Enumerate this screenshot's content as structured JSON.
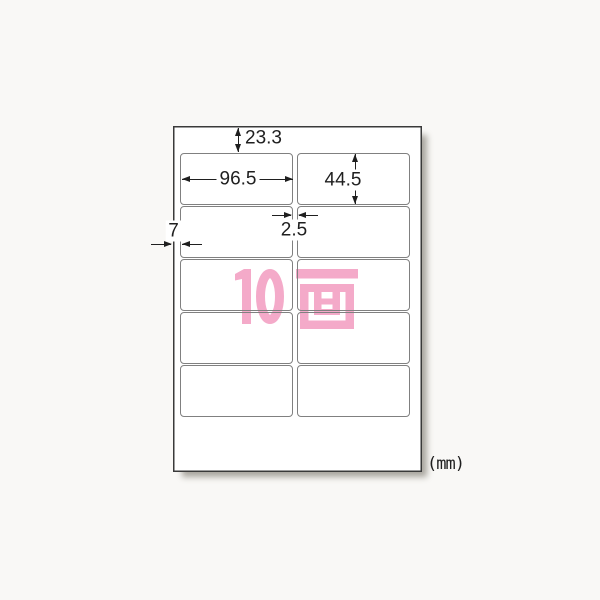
{
  "diagram": {
    "unit_note": "(mm)",
    "face_count": {
      "text": "10面",
      "digits": "10",
      "kanji": "面"
    },
    "dimensions": {
      "top_margin": "23.3",
      "label_width": "96.5",
      "label_height": "44.5",
      "column_gap": "2.5",
      "left_margin": "7"
    },
    "grid": {
      "columns": 2,
      "rows": 5,
      "total_labels": 10
    },
    "colors": {
      "page_bg": "#f9f8f6",
      "sheet_fill": "#ffffff",
      "sheet_border": "#3a3a3a",
      "label_border": "#808080",
      "dim_ink": "#1f1f1f",
      "face_count_pink": "#f4aac9",
      "shadow": "#a9a69f"
    }
  }
}
